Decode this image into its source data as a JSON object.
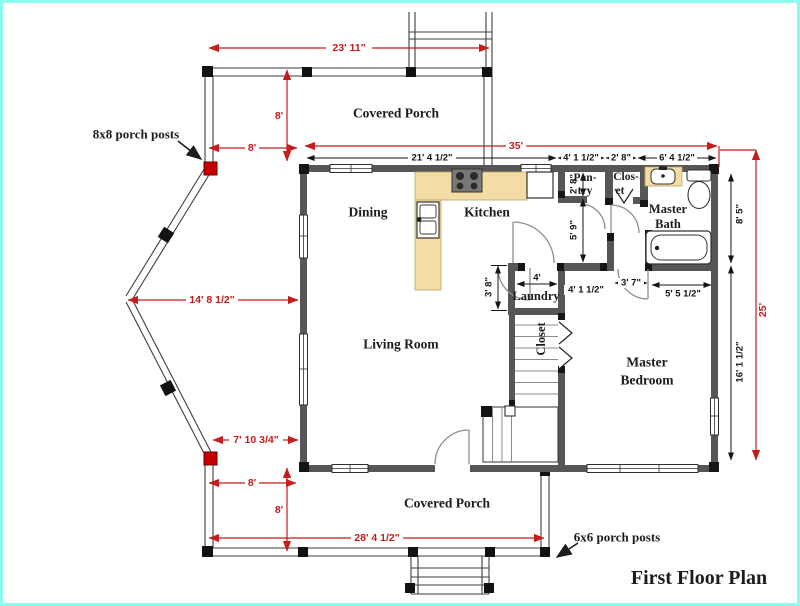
{
  "title": "First Floor Plan",
  "colors": {
    "dimension_red": "#c41d1d",
    "post_red": "#c60000",
    "wall_gray": "#565656",
    "counter_tan": "#f3dda4",
    "border_cyan": "#8cfbee"
  },
  "rooms": {
    "porch_top": "Covered Porch",
    "dining": "Dining",
    "kitchen": "Kitchen",
    "pantry": [
      "Pan-",
      "try"
    ],
    "closet_top": [
      "Clos-",
      "et"
    ],
    "master_bath": [
      "Master",
      "Bath"
    ],
    "laundry": "Laundry",
    "stair_closet": "Closet",
    "living_room": "Living Room",
    "master_bedroom": [
      "Master",
      "Bedroom"
    ],
    "porch_bottom": "Covered Porch"
  },
  "dims": {
    "porch_top_width": "23' 11\"",
    "porch_top_offset": "8'",
    "porch_top_depth": "8'",
    "house_width": "35'",
    "kitchen_dining_width": "21' 4 1/2\"",
    "hall_top_width": "4' 1 1/2\"",
    "closet_top_width": "2' 8\"",
    "bath_top_width": "6' 4 1/2\"",
    "pantry_depth": "2' 8\"",
    "hall_depth": "5' 9\"",
    "bath_right_side": "8' 5\"",
    "bay_width": "14' 8 1/2\"",
    "laundry_depth": "3' 8\"",
    "laundry_width": "4'",
    "hall_bottom_seg": "4' 1 1/2\"",
    "bedroom_door_seg": "3' 7\"",
    "tub_wall_seg": "5' 5 1/2\"",
    "bedroom_right_side": "16' 1 1/2\"",
    "house_depth": "25'",
    "bay_bottom_offset": "7' 10 3/4\"",
    "porch_bottom_offset": "8'",
    "porch_bottom_depth": "8'",
    "porch_bottom_width": "28' 4 1/2\""
  },
  "annotations": {
    "posts_8x8": "8x8 porch posts",
    "posts_6x6": "6x6 porch posts"
  }
}
